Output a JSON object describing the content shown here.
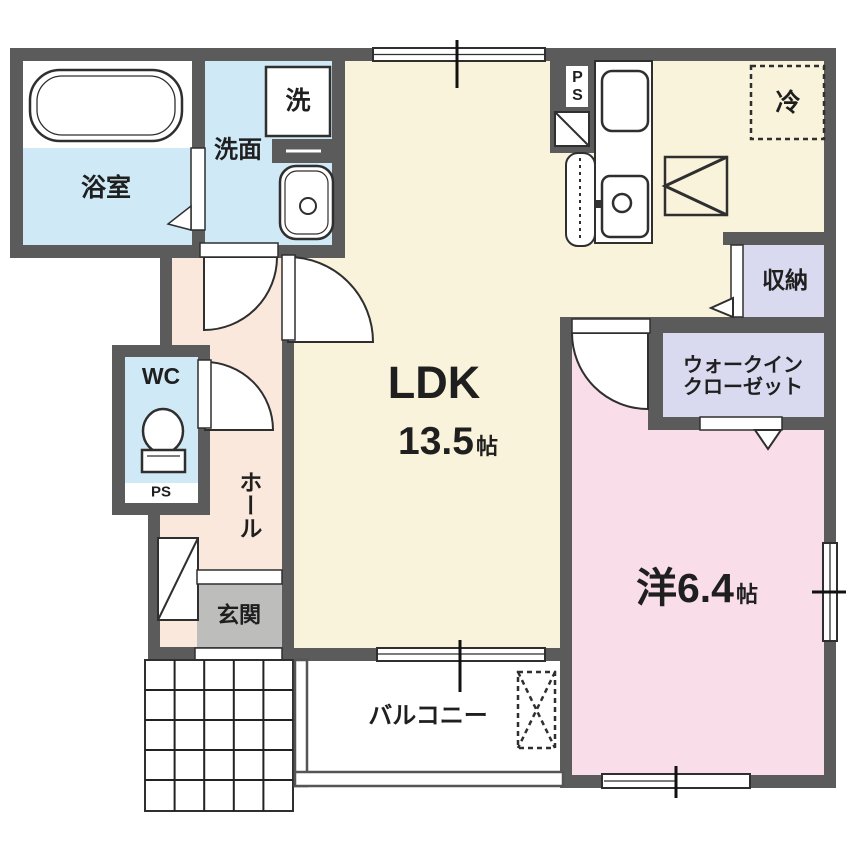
{
  "palette": {
    "wall": "#5b5b5b",
    "cream": "#faf3dc",
    "blue": "#cfe9f6",
    "peach": "#fbe8dc",
    "pink": "#f9dde9",
    "lavender": "#d9d9ef",
    "gray": "#bdbdbc",
    "line": "#2f2f2f",
    "text": "#1f1f1f"
  },
  "rooms": {
    "bath": {
      "label": "浴室"
    },
    "washroom": {
      "label": "洗面"
    },
    "ldk": {
      "label": "LDK",
      "size": "13.5",
      "unit": "帖"
    },
    "western_room": {
      "label": "洋6.4",
      "unit": "帖"
    },
    "storage": {
      "label": "収納"
    },
    "walk_in_closet": {
      "label_line1": "ウォークイン",
      "label_line2": "クローゼット"
    },
    "wc": {
      "label": "WC"
    },
    "hall": {
      "label": "ホール"
    },
    "entrance": {
      "label": "玄関"
    },
    "balcony": {
      "label": "バルコニー"
    }
  },
  "fixtures": {
    "washing_machine": {
      "label": "洗"
    },
    "refrigerator": {
      "label": "冷"
    },
    "pipe_space_kitchen": {
      "label": "PS"
    },
    "pipe_space_wc": {
      "label": "PS"
    }
  }
}
